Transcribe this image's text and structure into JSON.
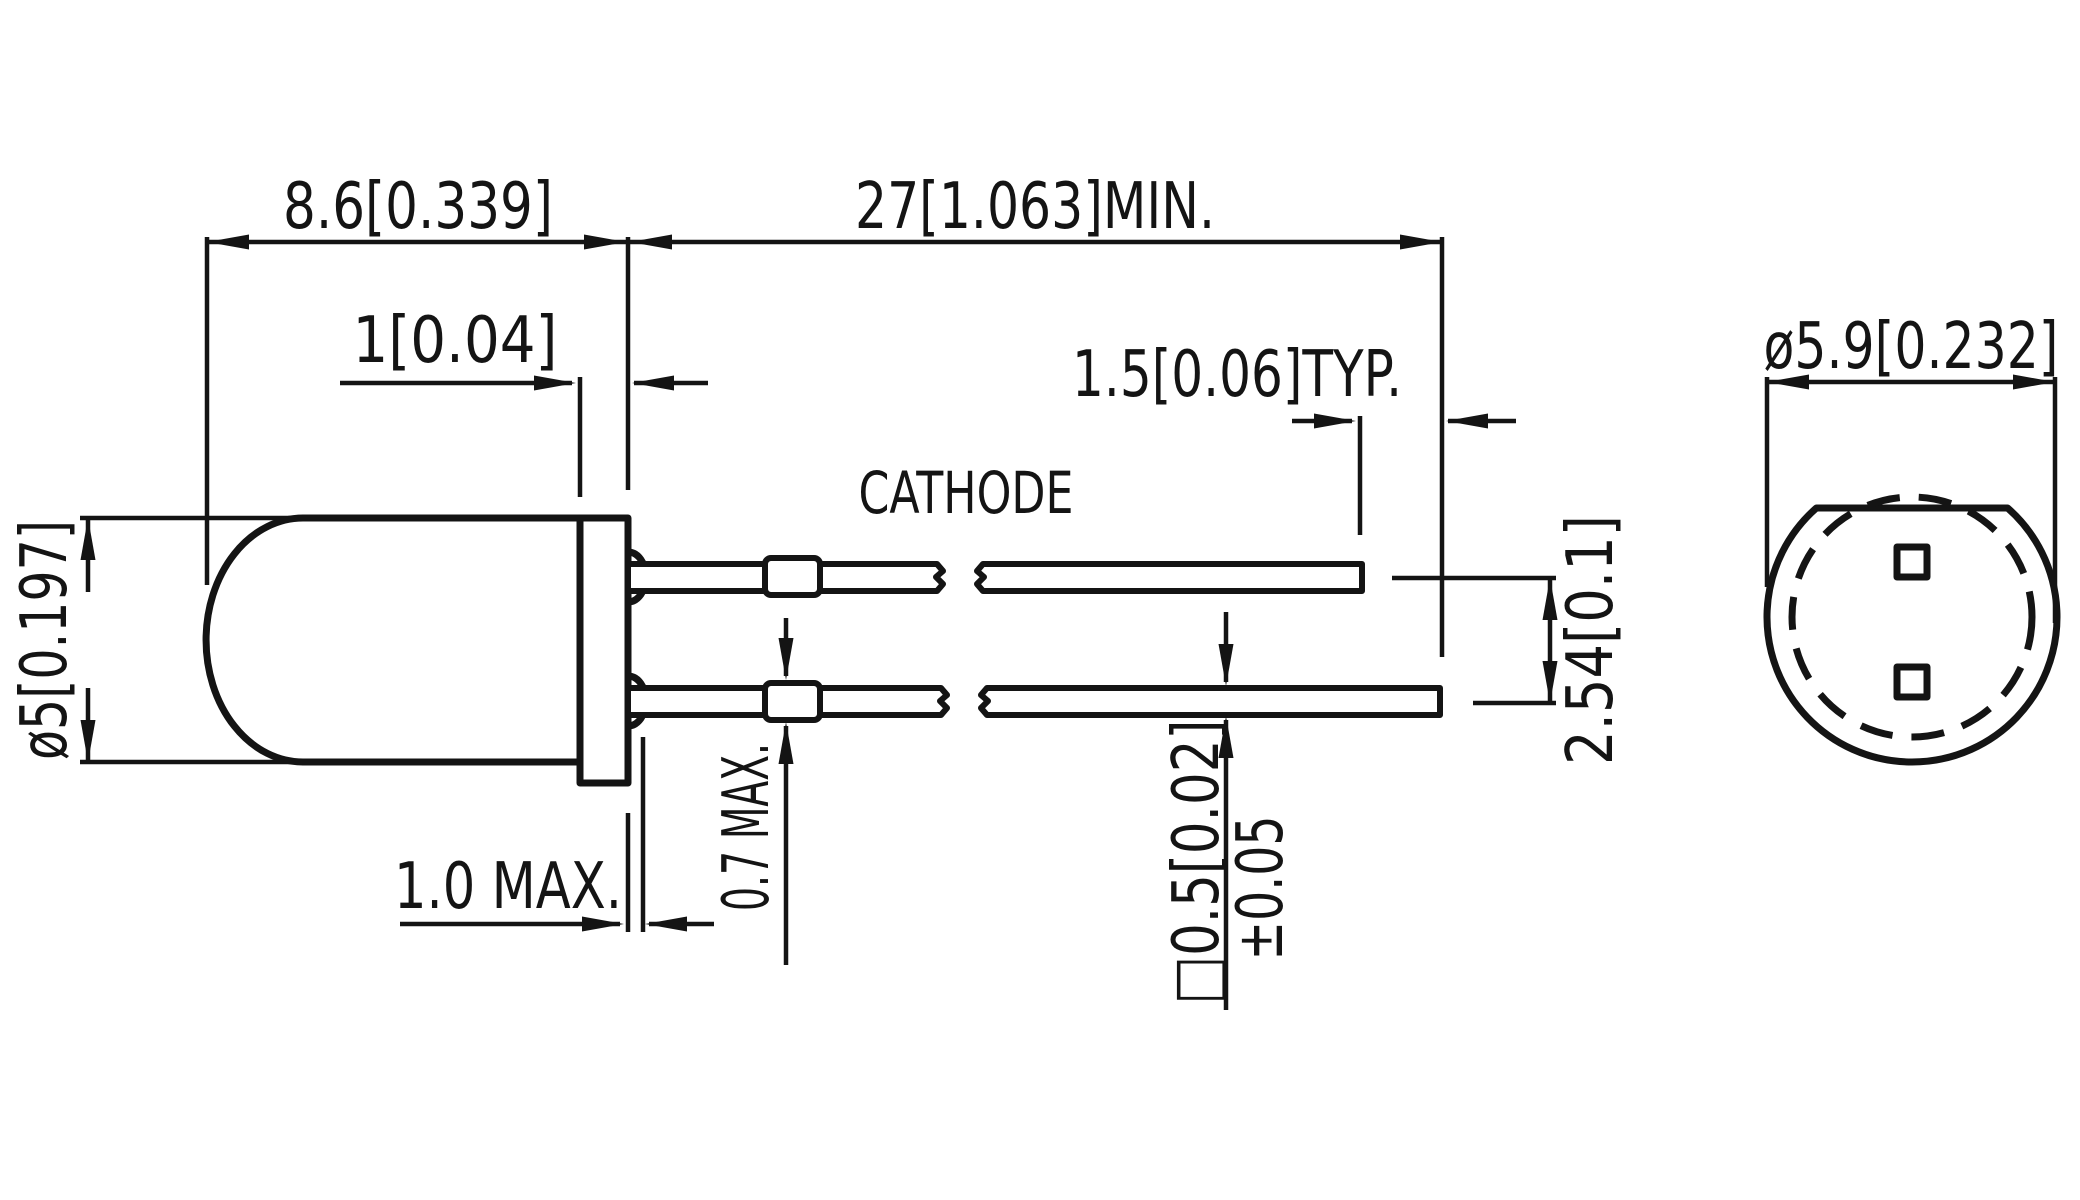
{
  "labels": {
    "cathode": "CATHODE"
  },
  "dims": {
    "body_length": "8.6[0.339]",
    "lead_length_min": "27[1.063]MIN.",
    "flange_thickness": "1[0.04]",
    "lead_tip_offset": "1.5[0.06]TYP.",
    "body_diameter": "ø5[0.197]",
    "lead_pitch": "2.54[0.1]",
    "lead_standoff_max": "0.7 MAX.",
    "flange_lip_max": "1.0 MAX.",
    "lead_square_section": "□0.5[0.02]",
    "lead_square_tolerance": "±0.05",
    "flange_diameter": "ø5.9[0.232]"
  },
  "colors": {
    "ink": "#141414",
    "paper": "#ffffff"
  }
}
